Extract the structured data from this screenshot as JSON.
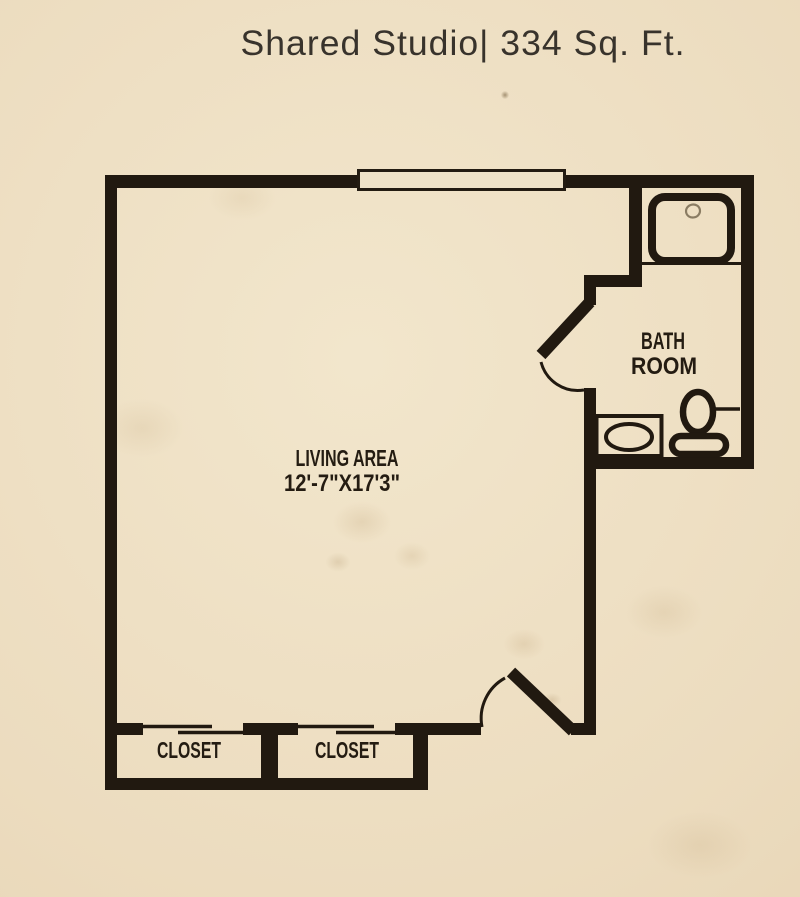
{
  "title": "Shared Studio| 334 Sq. Ft.",
  "rooms": {
    "living_area": {
      "label": "LIVING AREA",
      "dimensions": "12'-7\"X17'3\""
    },
    "bathroom": {
      "label_line1": "BATH",
      "label_line2": "ROOM"
    },
    "closet_left": {
      "label": "CLOSET"
    },
    "closet_right": {
      "label": "CLOSET"
    }
  },
  "fixtures": {
    "shower": "shower-pan-with-drain",
    "vanity_sink": "vanity-with-oval-basin",
    "toilet": "toilet-with-tank",
    "grab_bar": "grab-bar",
    "window": "window-in-top-wall",
    "entry_door": "entry-door-swing",
    "bathroom_door": "bathroom-door-swing",
    "closet_doors": "sliding-bypass-doors"
  },
  "colors": {
    "background": "#ecdcbf",
    "walls": "#211910",
    "labels": "#241c12",
    "title": "#38332c"
  }
}
